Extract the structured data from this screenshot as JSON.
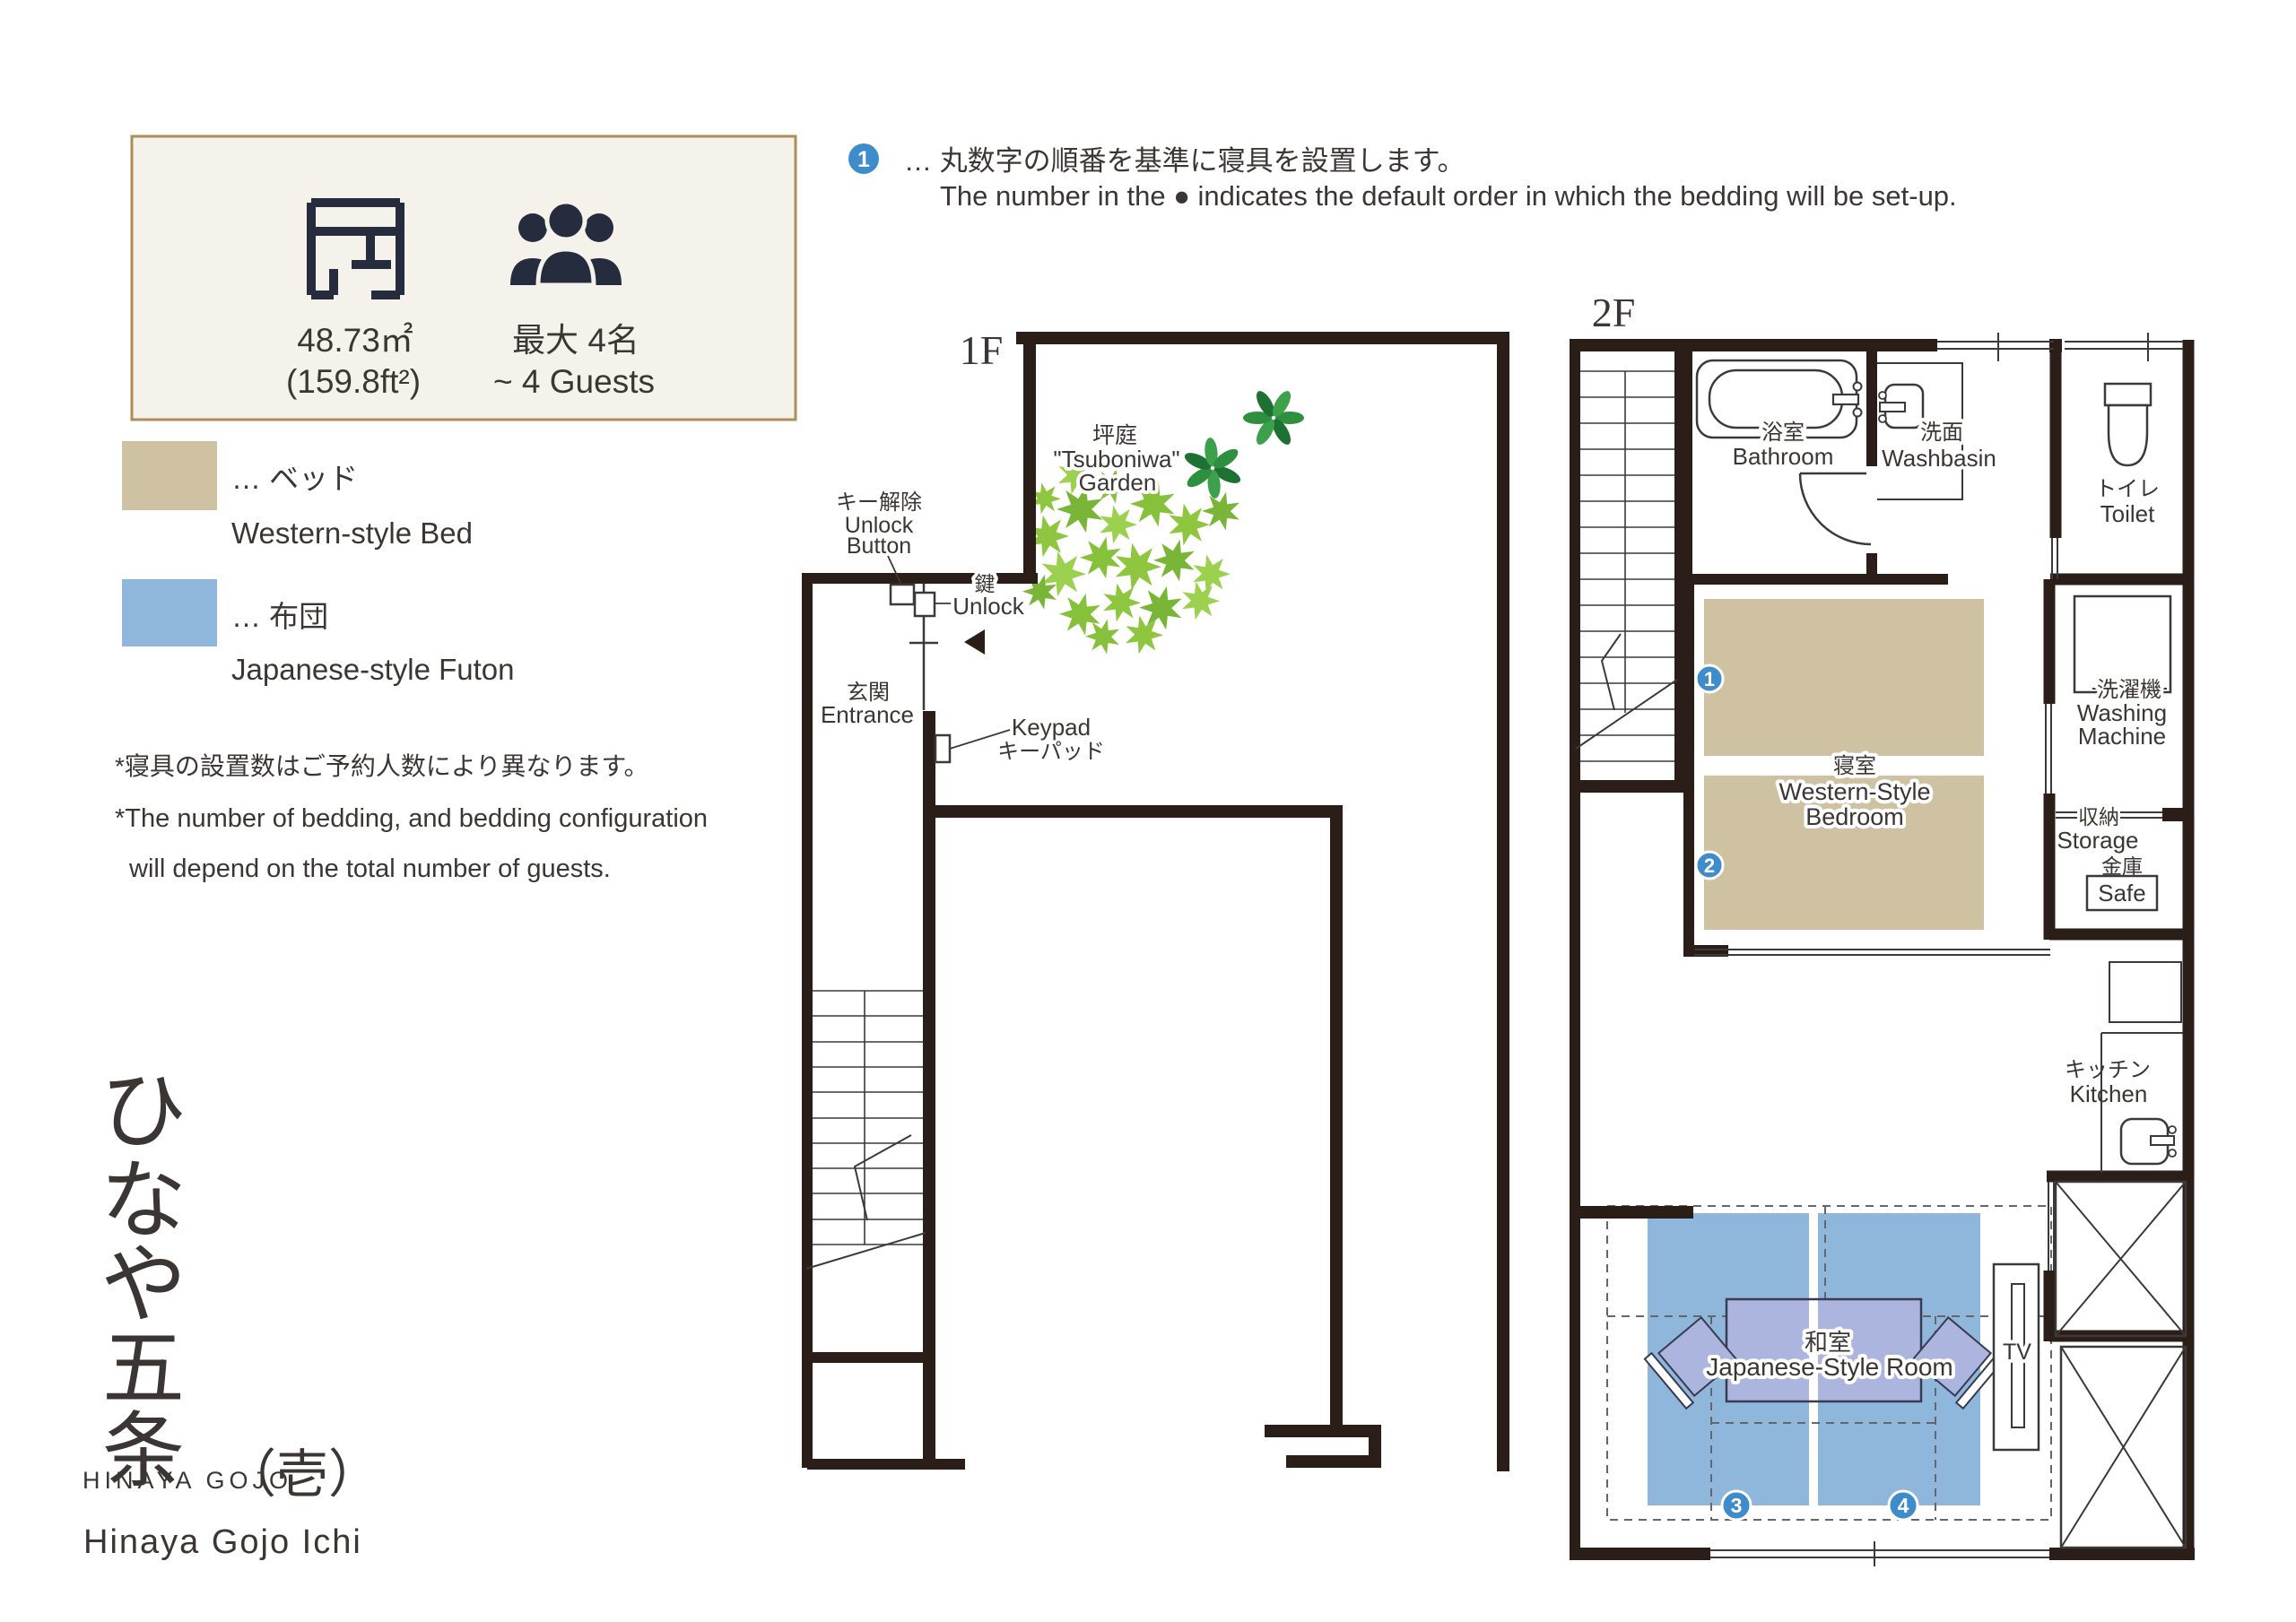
{
  "info_box": {
    "area_m2": "48.73㎡",
    "area_ft2": "(159.8ft²)",
    "capacity_jp": "最大 4名",
    "capacity_en": "~ 4 Guests"
  },
  "setup_note": {
    "badge": "1",
    "jp": "… 丸数字の順番を基準に寝具を設置します。",
    "en": "The number in the ● indicates the default order in which the bedding will be set-up."
  },
  "legend": {
    "bed_color": "#cfc2a3",
    "bed_jp": "… ベッド",
    "bed_en": "Western-style Bed",
    "futon_color": "#8fb7dc",
    "futon_jp": "… 布団",
    "futon_en": "Japanese-style Futon",
    "note_jp": "*寝具の設置数はご予約人数により異なります。",
    "note_en1": "*The number of bedding, and bedding configuration",
    "note_en2": "will depend on the total number of guests."
  },
  "floor1": {
    "label": "1F",
    "garden_jp": "坪庭",
    "garden_en1": "\"Tsuboniwa\"",
    "garden_en2": "Garden",
    "unlock_button_jp": "キー解除",
    "unlock_button_en1": "Unlock",
    "unlock_button_en2": "Button",
    "key_jp": "鍵",
    "key_en": "Unlock",
    "entrance_jp": "玄関",
    "entrance_en": "Entrance",
    "keypad_en": "Keypad",
    "keypad_jp": "キーパッド"
  },
  "floor2": {
    "label": "2F",
    "bathroom_jp": "浴室",
    "bathroom_en": "Bathroom",
    "washbasin_jp": "洗面",
    "washbasin_en": "Washbasin",
    "toilet_jp": "トイレ",
    "toilet_en": "Toilet",
    "bedroom_jp": "寝室",
    "bedroom_en1": "Western-Style",
    "bedroom_en2": "Bedroom",
    "washing_jp": "洗濯機",
    "washing_en1": "Washing",
    "washing_en2": "Machine",
    "storage_jp": "収納",
    "storage_en": "Storage",
    "safe_jp": "金庫",
    "safe_en": "Safe",
    "kitchen_jp": "キッチン",
    "kitchen_en": "Kitchen",
    "waroom_jp": "和室",
    "waroom_en": "Japanese-Style Room",
    "tv": "TV"
  },
  "badges": {
    "b1": "1",
    "b2": "2",
    "b3": "3",
    "b4": "4"
  },
  "logo": {
    "k1": "ひ",
    "k2": "な",
    "k3": "や",
    "k4": "五",
    "k5": "条",
    "latin": "HINAYA GOJO",
    "suffix": "（壱）",
    "romaji": "Hinaya Gojo Ichi"
  },
  "colors": {
    "wall": "#2b1d17",
    "bed": "#cfc2a3",
    "futon": "#8fb7dc",
    "table": "#abb5de",
    "badge_blue": "#3f8ccb",
    "leaf_light": "#8ec63f",
    "leaf_dark": "#2e8f3e",
    "box_border": "#b08d57",
    "box_bg": "#f5f2eb"
  }
}
